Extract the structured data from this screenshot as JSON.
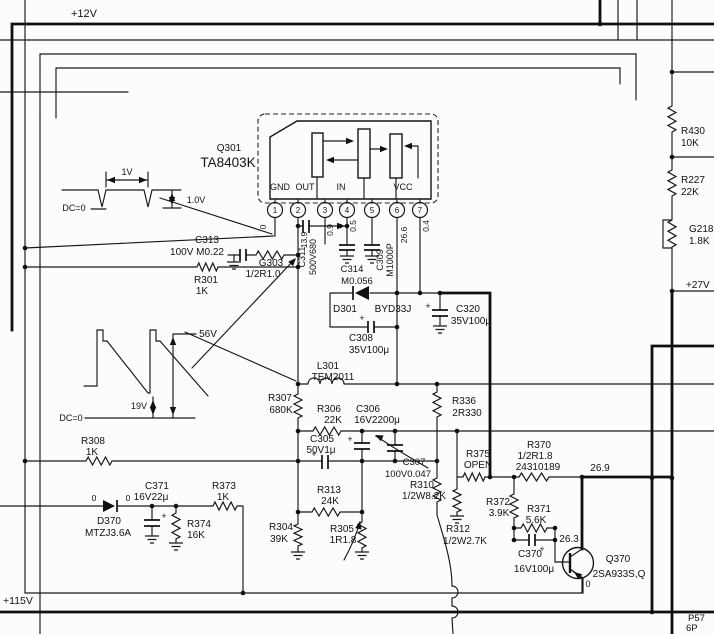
{
  "meta": {
    "kind": "circuit-schematic",
    "main_ic": "TA8403K vertical output"
  },
  "labels": {
    "power": [
      {
        "n": "net-plus12v",
        "t": "+12V",
        "x": 84,
        "y": 17,
        "s": 11
      },
      {
        "n": "net-plus115v",
        "t": "+115V",
        "x": 3,
        "y": 604,
        "s": 10.5,
        "a": "start"
      },
      {
        "n": "net-plus27v",
        "t": "+27V",
        "x": 686,
        "y": 288,
        "a": "start"
      }
    ],
    "connector": [
      {
        "n": "connector-p57",
        "t": "P57",
        "x": 688,
        "y": 621,
        "s": 9.5,
        "a": "start"
      },
      {
        "n": "connector-6p",
        "t": "6P",
        "x": 686,
        "y": 631,
        "s": 9.5,
        "a": "start"
      }
    ],
    "ic": [
      {
        "n": "ic-ref",
        "t": "Q301",
        "x": 229,
        "y": 151
      },
      {
        "n": "ic-part",
        "t": "TA8403K",
        "x": 228,
        "y": 167,
        "s": 13.5
      },
      {
        "n": "ic-pad-gnd",
        "t": "GND",
        "x": 280,
        "y": 190,
        "s": 9
      },
      {
        "n": "ic-pad-out",
        "t": "OUT",
        "x": 305,
        "y": 190,
        "s": 9
      },
      {
        "n": "ic-pad-in",
        "t": "IN",
        "x": 341,
        "y": 190,
        "s": 9
      },
      {
        "n": "ic-pad-vcc",
        "t": "VCC",
        "x": 403,
        "y": 190,
        "s": 9
      }
    ],
    "pin_numbers": [
      {
        "n": "pin-1",
        "t": "1",
        "x": 275,
        "y": 213,
        "s": 8
      },
      {
        "n": "pin-2",
        "t": "2",
        "x": 298,
        "y": 213,
        "s": 8
      },
      {
        "n": "pin-3",
        "t": "3",
        "x": 325,
        "y": 213,
        "s": 8
      },
      {
        "n": "pin-4",
        "t": "4",
        "x": 347,
        "y": 213,
        "s": 8
      },
      {
        "n": "pin-5",
        "t": "5",
        "x": 372,
        "y": 213,
        "s": 8
      },
      {
        "n": "pin-6",
        "t": "6",
        "x": 397,
        "y": 213,
        "s": 8
      },
      {
        "n": "pin-7",
        "t": "7",
        "x": 420,
        "y": 213,
        "s": 8
      }
    ],
    "pin_voltages": [
      {
        "n": "pin1-voltage",
        "t": "0",
        "x": 266,
        "y": 227,
        "s": 8.5,
        "r": -90
      },
      {
        "n": "pin2-voltage",
        "t": "13.9",
        "x": 307,
        "y": 240,
        "s": 8.5,
        "r": -90
      },
      {
        "n": "pin3-voltage",
        "t": "0.9",
        "x": 333,
        "y": 230,
        "s": 8.5,
        "r": -90
      },
      {
        "n": "pin4-voltage",
        "t": "0.5",
        "x": 356,
        "y": 226,
        "s": 8.5,
        "r": -90
      },
      {
        "n": "pin6-voltage",
        "t": "26.6",
        "x": 407,
        "y": 235,
        "s": 8.5,
        "r": -90
      },
      {
        "n": "pin7-voltage",
        "t": "0.4",
        "x": 429,
        "y": 226,
        "s": 8.5,
        "r": -90
      }
    ],
    "waveform_top": [
      {
        "n": "wf1-period",
        "t": "1V",
        "x": 127,
        "y": 175,
        "s": 9
      },
      {
        "n": "wf1-amplitude",
        "t": "1.0V",
        "x": 196,
        "y": 203,
        "s": 9
      },
      {
        "n": "wf1-baseline",
        "t": "DC=0",
        "x": 74,
        "y": 211,
        "s": 9
      }
    ],
    "waveform_bottom": [
      {
        "n": "wf2-peak",
        "t": "56V",
        "x": 208,
        "y": 337,
        "s": 10
      },
      {
        "n": "wf2-level",
        "t": "19V",
        "x": 139,
        "y": 409,
        "s": 9
      },
      {
        "n": "wf2-baseline",
        "t": "DC=0",
        "x": 71,
        "y": 421,
        "s": 9
      }
    ],
    "test_voltages": [
      {
        "n": "tv-r370-out",
        "t": "26.9",
        "x": 600,
        "y": 471
      },
      {
        "n": "tv-q370-base",
        "t": "26.3",
        "x": 569,
        "y": 542
      },
      {
        "n": "tv-d370-anode",
        "t": "0",
        "x": 94,
        "y": 501,
        "s": 8.5
      },
      {
        "n": "tv-d370-cathode",
        "t": "0",
        "x": 128,
        "y": 501,
        "s": 8.5
      },
      {
        "n": "tv-q370-emitter",
        "t": "0",
        "x": 588,
        "y": 587,
        "s": 9
      }
    ],
    "components": [
      {
        "n": "c313-ref",
        "t": "C313",
        "x": 207,
        "y": 243
      },
      {
        "n": "c313-val",
        "t": "100V M0.22",
        "x": 197,
        "y": 255
      },
      {
        "n": "g303-ref",
        "t": "G303",
        "x": 271,
        "y": 266
      },
      {
        "n": "g303-val",
        "t": "1/2R1.0",
        "x": 263,
        "y": 277
      },
      {
        "n": "c311-ref",
        "t": "C311",
        "x": 305,
        "y": 257,
        "s": 9,
        "r": -90
      },
      {
        "n": "c311-val",
        "t": "500V680",
        "x": 316,
        "y": 257,
        "s": 9,
        "r": -90
      },
      {
        "n": "r301-ref",
        "t": "R301",
        "x": 206,
        "y": 283
      },
      {
        "n": "r301-val",
        "t": "1K",
        "x": 202,
        "y": 294
      },
      {
        "n": "c314-ref",
        "t": "C314",
        "x": 352,
        "y": 272,
        "s": 9.5
      },
      {
        "n": "c314-val",
        "t": "M0.056",
        "x": 357,
        "y": 284,
        "s": 9.5
      },
      {
        "n": "c309-ref",
        "t": "C309",
        "x": 383,
        "y": 260,
        "s": 9,
        "r": -90
      },
      {
        "n": "c309-val",
        "t": "M1000P",
        "x": 393,
        "y": 260,
        "s": 9,
        "r": -90
      },
      {
        "n": "d301-ref",
        "t": "D301",
        "x": 345,
        "y": 312
      },
      {
        "n": "d301-val",
        "t": "BYD33J",
        "x": 393,
        "y": 312
      },
      {
        "n": "c308-ref",
        "t": "C308",
        "x": 361,
        "y": 341
      },
      {
        "n": "c308-val",
        "t": "35V100μ",
        "x": 369,
        "y": 353
      },
      {
        "n": "c320-ref",
        "t": "C320",
        "x": 468,
        "y": 312
      },
      {
        "n": "c320-val",
        "t": "35V100μ",
        "x": 471,
        "y": 324
      },
      {
        "n": "l301-ref",
        "t": "L301",
        "x": 328,
        "y": 369
      },
      {
        "n": "l301-val",
        "t": "TEM2011",
        "x": 333,
        "y": 380
      },
      {
        "n": "r307-ref",
        "t": "R307",
        "x": 280,
        "y": 401
      },
      {
        "n": "r307-val",
        "t": "680K",
        "x": 281,
        "y": 413
      },
      {
        "n": "r306-ref",
        "t": "R306",
        "x": 329,
        "y": 412
      },
      {
        "n": "r306-val",
        "t": "22K",
        "x": 333,
        "y": 423
      },
      {
        "n": "c306-ref",
        "t": "C306",
        "x": 368,
        "y": 412
      },
      {
        "n": "c306-val",
        "t": "16V2200μ",
        "x": 377,
        "y": 423
      },
      {
        "n": "r336-ref",
        "t": "R336",
        "x": 464,
        "y": 404
      },
      {
        "n": "r336-val",
        "t": "2R330",
        "x": 467,
        "y": 416
      },
      {
        "n": "c305-ref",
        "t": "C305",
        "x": 322,
        "y": 442
      },
      {
        "n": "c305-val",
        "t": "50V1μ",
        "x": 321,
        "y": 453
      },
      {
        "n": "c307-ref",
        "t": "C307",
        "x": 414,
        "y": 465,
        "s": 9.5
      },
      {
        "n": "c307-val",
        "t": "100V0.047",
        "x": 408,
        "y": 477,
        "s": 9.5
      },
      {
        "n": "r310-ref",
        "t": "R310",
        "x": 422,
        "y": 488
      },
      {
        "n": "r310-val",
        "t": "1/2W8.2K",
        "x": 424,
        "y": 499
      },
      {
        "n": "r313-ref",
        "t": "R313",
        "x": 329,
        "y": 493
      },
      {
        "n": "r313-val",
        "t": "24K",
        "x": 330,
        "y": 504
      },
      {
        "n": "r304-ref",
        "t": "R304",
        "x": 281,
        "y": 530
      },
      {
        "n": "r304-val",
        "t": "39K",
        "x": 279,
        "y": 542
      },
      {
        "n": "r305-ref",
        "t": "R305",
        "x": 342,
        "y": 532
      },
      {
        "n": "r305-val",
        "t": "1R1.8",
        "x": 343,
        "y": 543
      },
      {
        "n": "r308-ref",
        "t": "R308",
        "x": 93,
        "y": 444
      },
      {
        "n": "r308-val",
        "t": "1K",
        "x": 92,
        "y": 455
      },
      {
        "n": "c371-ref",
        "t": "C371",
        "x": 157,
        "y": 489
      },
      {
        "n": "c371-val",
        "t": "16V22μ",
        "x": 151,
        "y": 500
      },
      {
        "n": "r373-ref",
        "t": "R373",
        "x": 224,
        "y": 489
      },
      {
        "n": "r373-val",
        "t": "1K",
        "x": 223,
        "y": 500
      },
      {
        "n": "d370-ref",
        "t": "D370",
        "x": 109,
        "y": 524
      },
      {
        "n": "d370-val",
        "t": "MTZJ3.6A",
        "x": 108,
        "y": 536
      },
      {
        "n": "r374-ref",
        "t": "R374",
        "x": 199,
        "y": 527
      },
      {
        "n": "r374-val",
        "t": "16K",
        "x": 196,
        "y": 538
      },
      {
        "n": "r375-ref",
        "t": "R375",
        "x": 478,
        "y": 457
      },
      {
        "n": "r375-val",
        "t": "OPEN",
        "x": 478,
        "y": 468
      },
      {
        "n": "r370-ref",
        "t": "R370",
        "x": 539,
        "y": 448
      },
      {
        "n": "r370-val",
        "t": "1/2R1.8",
        "x": 535,
        "y": 459
      },
      {
        "n": "r370-code",
        "t": "24310189",
        "x": 538,
        "y": 470
      },
      {
        "n": "r372-ref",
        "t": "R372",
        "x": 498,
        "y": 505
      },
      {
        "n": "r372-val",
        "t": "3.9K",
        "x": 499,
        "y": 516
      },
      {
        "n": "r371-ref",
        "t": "R371",
        "x": 539,
        "y": 512
      },
      {
        "n": "r371-val",
        "t": "5.6K",
        "x": 536,
        "y": 523
      },
      {
        "n": "r312-ref",
        "t": "R312",
        "x": 458,
        "y": 532
      },
      {
        "n": "r312-val",
        "t": "1/2W2.7K",
        "x": 465,
        "y": 544
      },
      {
        "n": "c370-ref",
        "t": "C370",
        "x": 530,
        "y": 557
      },
      {
        "n": "c370-val",
        "t": "16V100μ",
        "x": 534,
        "y": 572
      },
      {
        "n": "q370-ref",
        "t": "Q370",
        "x": 618,
        "y": 562
      },
      {
        "n": "q370-part",
        "t": "2SA933S,Q",
        "x": 619,
        "y": 577
      },
      {
        "n": "r430-ref",
        "t": "R430",
        "x": 681,
        "y": 134,
        "a": "start"
      },
      {
        "n": "r430-val",
        "t": "10K",
        "x": 681,
        "y": 146,
        "a": "start"
      },
      {
        "n": "r227-ref",
        "t": "R227",
        "x": 681,
        "y": 183,
        "a": "start"
      },
      {
        "n": "r227-val",
        "t": "22K",
        "x": 681,
        "y": 195,
        "a": "start"
      },
      {
        "n": "g218-ref",
        "t": "G218",
        "x": 689,
        "y": 232,
        "a": "start"
      },
      {
        "n": "g218-val",
        "t": "1.8K",
        "x": 689,
        "y": 244,
        "a": "start"
      }
    ],
    "polarity_marks": [
      {
        "n": "c308-plus",
        "t": "+",
        "x": 362,
        "y": 321,
        "s": 9
      },
      {
        "n": "c320-plus",
        "t": "+",
        "x": 428,
        "y": 309,
        "s": 9
      },
      {
        "n": "c306-plus",
        "t": "+",
        "x": 350,
        "y": 442,
        "s": 9
      },
      {
        "n": "c305-plus",
        "t": "+",
        "x": 314,
        "y": 457,
        "s": 9
      },
      {
        "n": "c371-plus",
        "t": "+",
        "x": 164,
        "y": 519,
        "s": 9
      },
      {
        "n": "c370-plus",
        "t": "+",
        "x": 542,
        "y": 552,
        "s": 9
      }
    ]
  }
}
